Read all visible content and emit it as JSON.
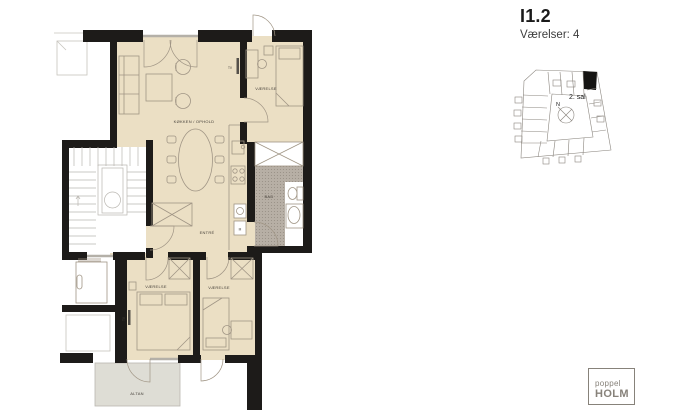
{
  "header": {
    "unit_id": "I1.2",
    "rooms_label": "Værelser: 4"
  },
  "site_plan": {
    "floor_label": "2. sal",
    "north_label": "N"
  },
  "plan_labels": {
    "kitchen_living": "KØKKEN / OPHOLD",
    "bedroom_top": "VÆRELSE",
    "bedroom_left": "VÆRELSE",
    "bedroom_right": "VÆRELSE",
    "entry": "ENTRÉ",
    "bathroom": "BAD",
    "balcony": "ALTAN",
    "tv_living": "TV",
    "tv_bedroom": "TV",
    "washer": "M"
  },
  "logo": {
    "line1": "poppel",
    "line2": "HOLM"
  },
  "colors": {
    "wall": "#1d1b19",
    "floor": "#ebdfc4",
    "tilebg": "#b7afa5",
    "tiledot": "#948c82",
    "balcony": "#deddd5",
    "line": "#a09585",
    "stair": "#b9b6b0",
    "window": "#b4b0a8",
    "text": "#46413a",
    "map": "#8b867f",
    "logo": "#87827a"
  }
}
